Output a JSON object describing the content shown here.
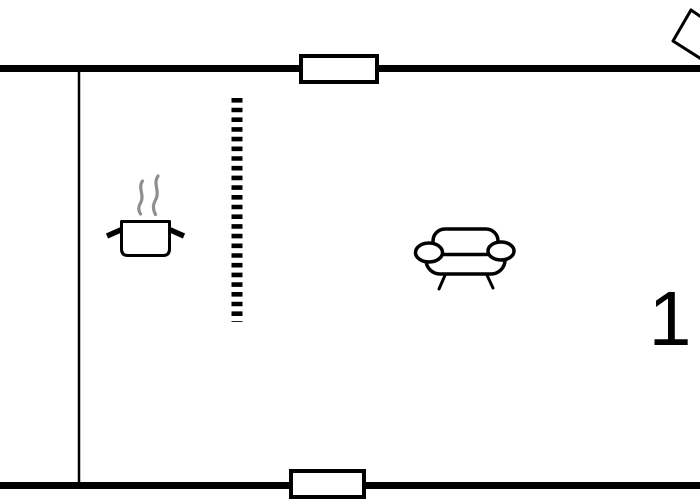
{
  "floor_plan": {
    "room_number": "1",
    "colors": {
      "line": "#000000",
      "steam": "#8f8f8f",
      "background": "#ffffff"
    },
    "icons": [
      "cooking-pot-icon",
      "steam-icon",
      "sofa-icon",
      "corner-flag-icon"
    ],
    "features": [
      "top-wall",
      "bottom-wall",
      "interior-wall",
      "top-window",
      "bottom-window",
      "dashed-divider"
    ]
  }
}
